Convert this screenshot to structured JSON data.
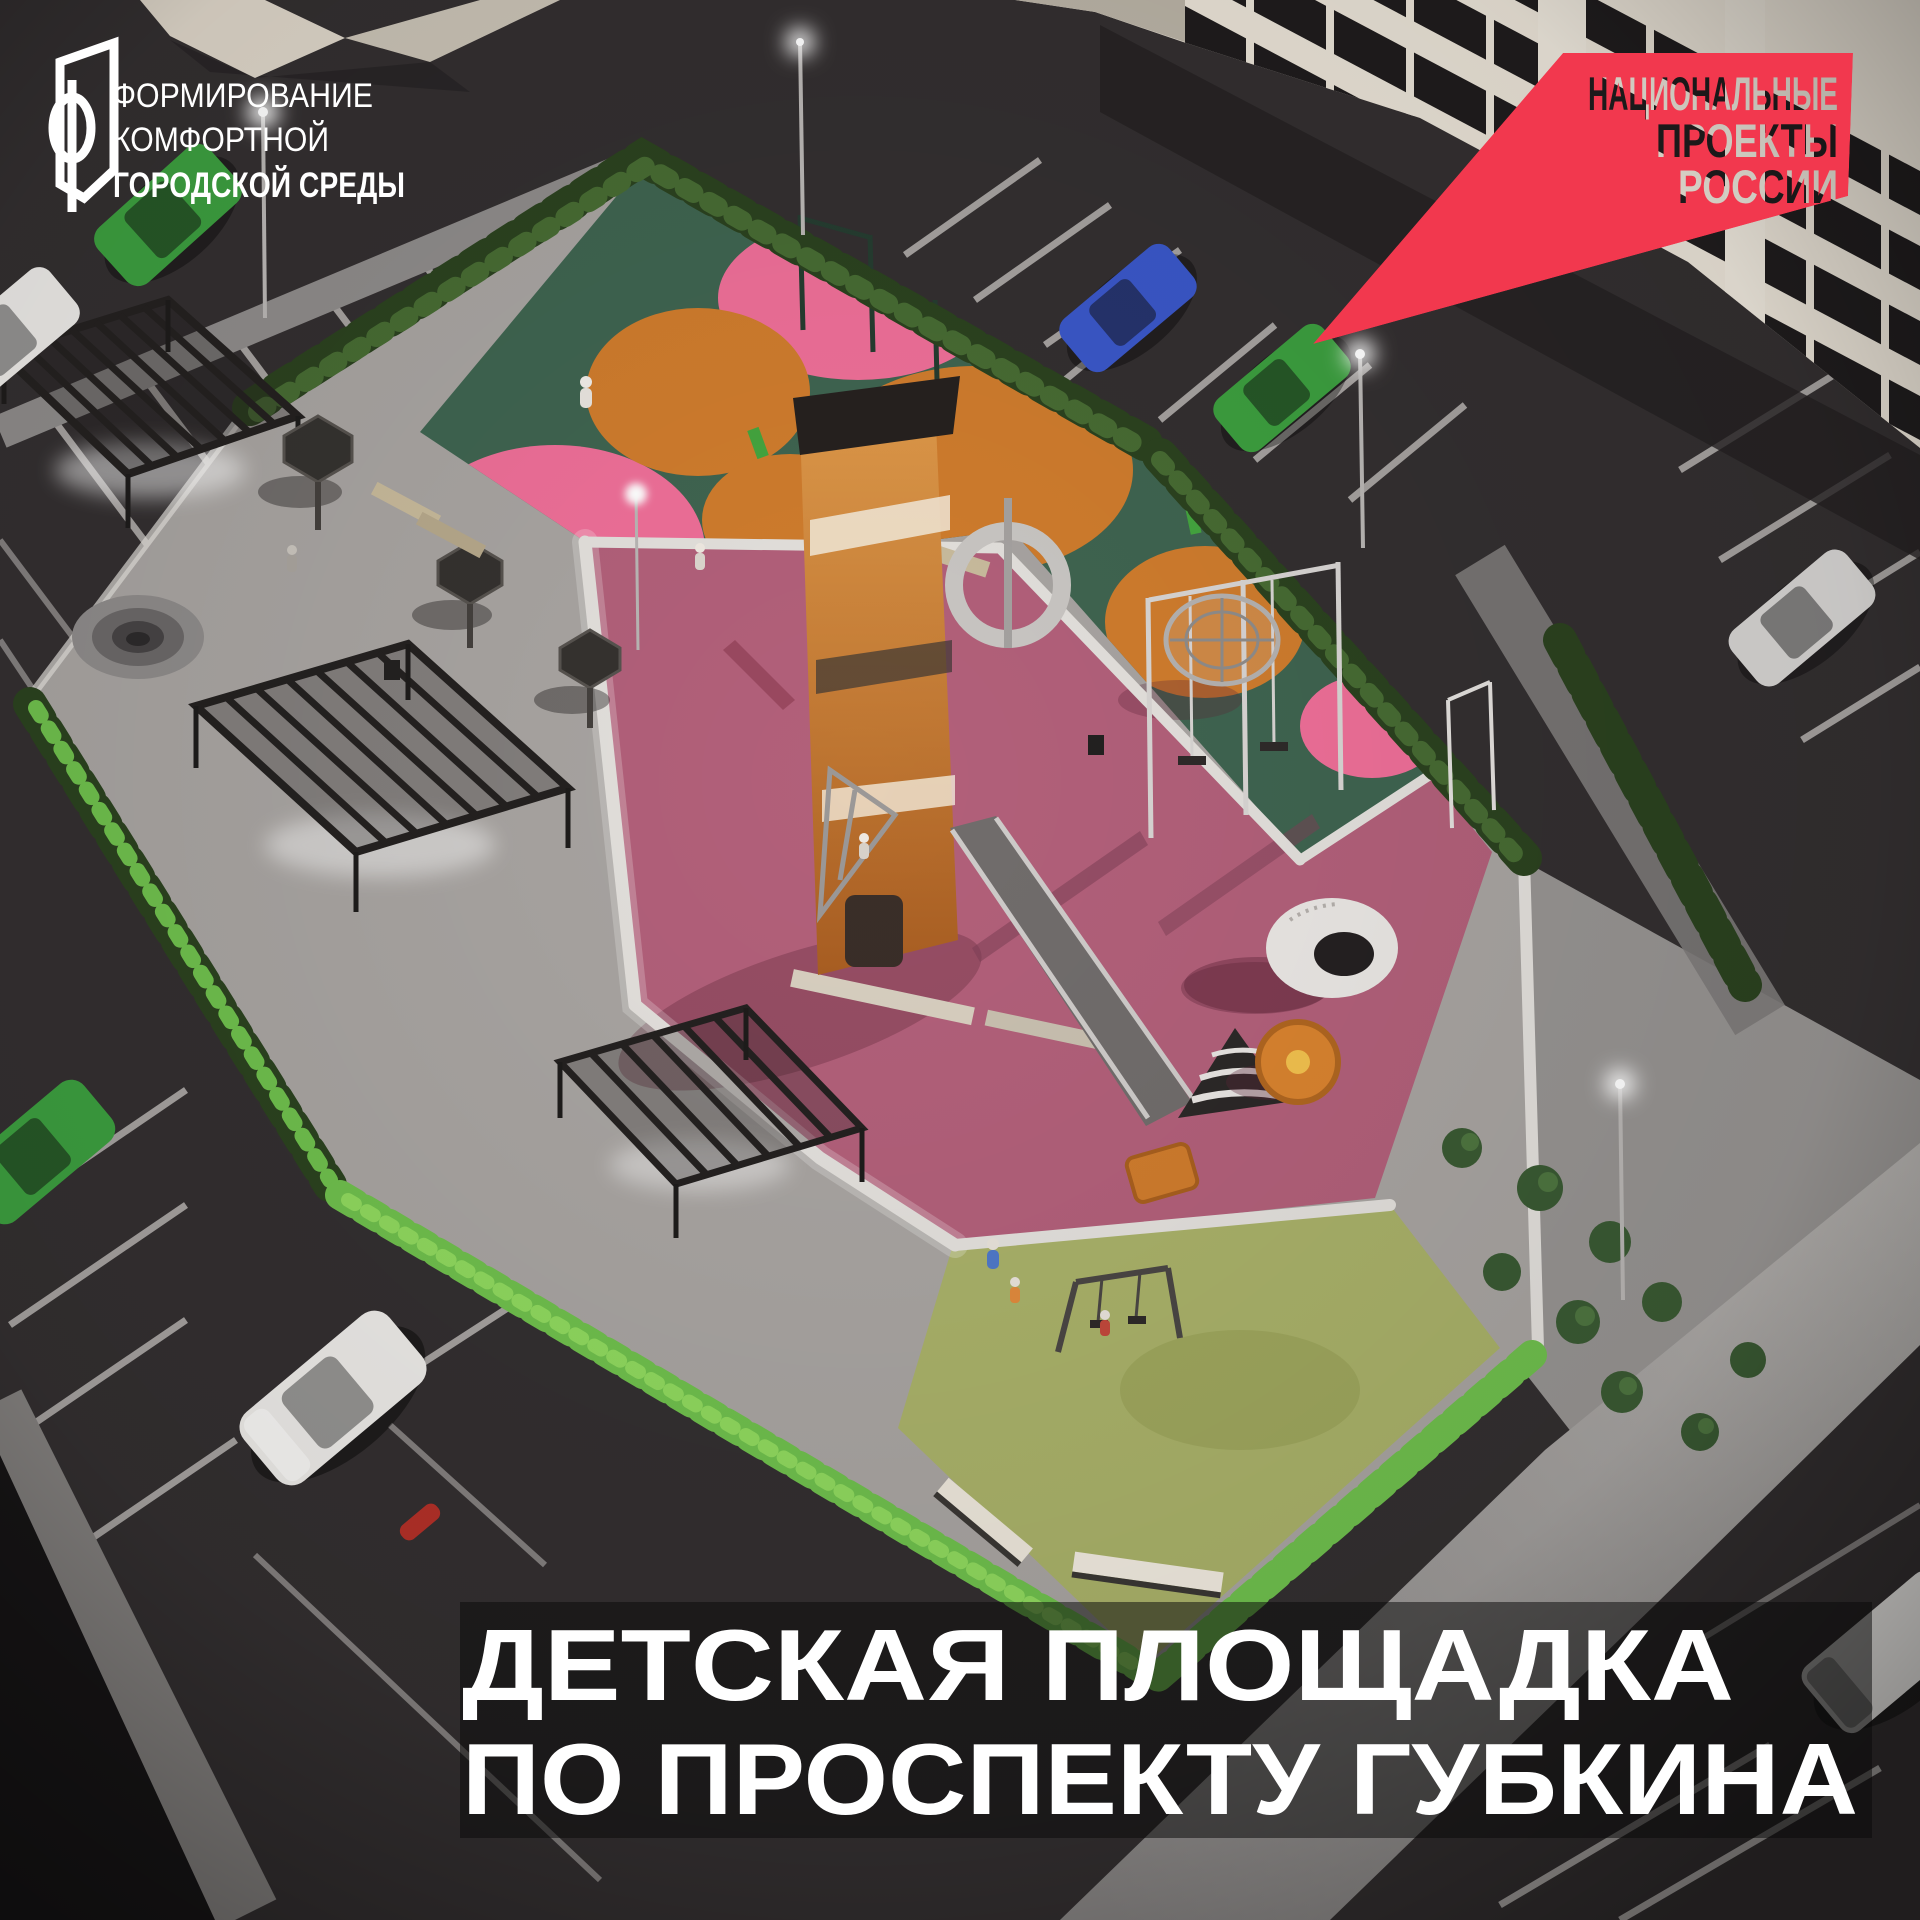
{
  "logos": {
    "fkgs": {
      "line1": "ФОРМИРОВАНИЕ",
      "line2": "КОМФОРТНОЙ",
      "line3": "ГОРОДСКОЙ СРЕДЫ",
      "color": "#ffffff"
    },
    "national_projects": {
      "line1": "НАЦИОНАЛЬНЫЕ",
      "line2": "ПРОЕКТЫ",
      "line3": "РОССИИ",
      "flag_color": "#f2384e"
    }
  },
  "title": {
    "line1": "ДЕТСКАЯ ПЛОЩАДКА",
    "line2": "ПО ПРОСПЕКТУ ГУБКИНА",
    "text_color": "#ffffff",
    "panel_color": "rgba(10,10,10,0.52)"
  },
  "scene": {
    "description": "Night aerial 3D render of a children's playground with colored rubber zones, pergola plaza, hedges, parking lots with cars and apartment buildings",
    "palette": {
      "asphalt": "#332f30",
      "paving": "#a8a4a1",
      "road": "#979492",
      "green_zone": "#3f6450",
      "rose_zone": "#b2607a",
      "olive_zone": "#a9b169",
      "pink_circle": "#ee6f98",
      "orange_circle": "#cf7c2d",
      "building_wall": "#e9e2d6",
      "building_window": "#1f1c1d",
      "car_blue": "#3a57c8",
      "car_green": "#3c9e3f",
      "car_white": "#eceae7",
      "car_silver": "#d7d5d3",
      "car_red": "#b33028",
      "tower_orange": "#d28a3e",
      "volcano_white": "#eae7e4",
      "carousel_orange": "#d9832f"
    }
  }
}
